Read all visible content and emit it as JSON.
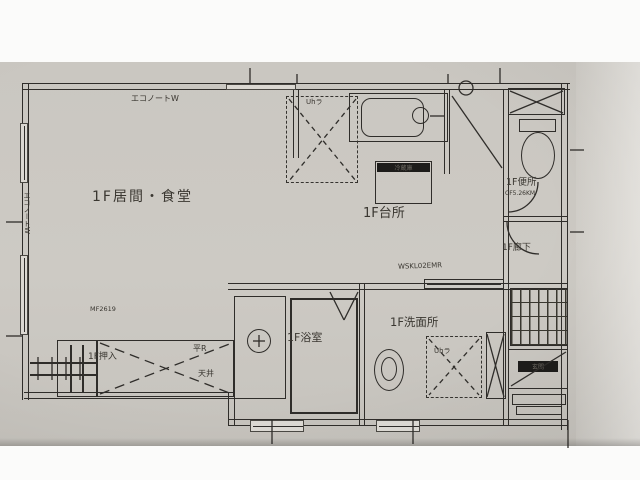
{
  "colors": {
    "paper": "#cac7c1",
    "ink": "#2f2d2a",
    "margin_white": "#fbfbfa"
  },
  "plan": {
    "rooms": {
      "living": {
        "label": "1F居間・食堂"
      },
      "kitchen": {
        "label": "1F台所"
      },
      "toilet": {
        "label": "1F便所",
        "note": "CF5.26KM"
      },
      "hall": {
        "label": "1F廊下"
      },
      "bath": {
        "label": "1F浴室"
      },
      "washroom": {
        "label": "1F洗面所",
        "note": "WSKL02EMR"
      },
      "closet": {
        "label": "1F押入",
        "note1": "平R",
        "note2": "天井"
      },
      "entry": {
        "label": "玄関"
      }
    },
    "annotations": {
      "top_wall": "エコノートW",
      "left_wall": "エコノートW",
      "closet_small": "MF2619",
      "fridge": "冷蔵庫",
      "cabinet": "Uhラ",
      "laundry": "Uhラ"
    }
  }
}
